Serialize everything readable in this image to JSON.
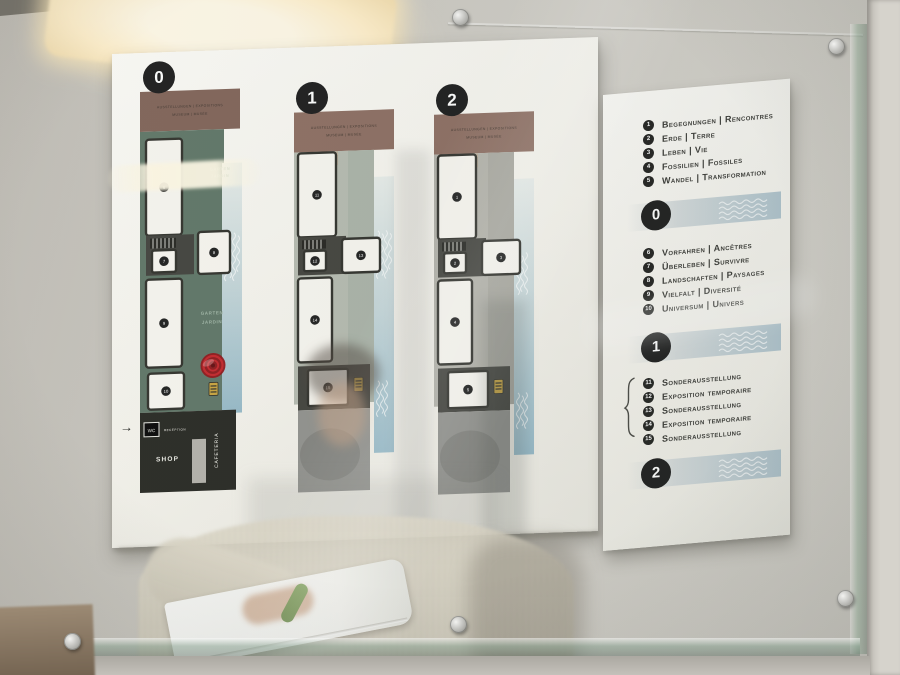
{
  "icons": {
    "entrance_arrow": "→",
    "brace": "{"
  },
  "colors": {
    "poster_white": "#f7f5f0",
    "band_brown": "#8a6a5e",
    "band_brown_floor0": "#7d5f54",
    "garden_green": "#5b7263",
    "floor1_bg": "#b4b9ae",
    "floor1_bg2": "#a8b1a6",
    "floor2_bg": "#b1b0a8",
    "floor2_bg2": "#a7a69e",
    "river_blue": "#94b8c7",
    "marker_red": "#a51016",
    "lift_yellow": "#c9a23a",
    "circle_black": "#161616"
  },
  "plans": {
    "floors": [
      {
        "badge": "0",
        "header_line1": "AUSSTELLUNGEN | EXPOSITIONS",
        "header_line2": "MUSEUM | MUSÉE",
        "bg": "#5b7263",
        "rooms": {
          "a": "6",
          "core": "7",
          "b": "8",
          "c": "9",
          "d": "10"
        },
        "garden": {
          "line1": "GARTEN",
          "line2": "JARDIN"
        },
        "amenities": {
          "wc": "WC",
          "reception": "RECEPTION",
          "shop": "SHOP",
          "cafeteria": "CAFETERIA"
        }
      },
      {
        "badge": "1",
        "header_line1": "AUSSTELLUNGEN | EXPOSITIONS",
        "header_line2": "MUSEUM | MUSÉE",
        "bg": "#b4b9ae",
        "bg2": "#a8b1a6",
        "rooms": {
          "a": "11",
          "core": "12",
          "b": "13",
          "c": "14",
          "d": "15"
        }
      },
      {
        "badge": "2",
        "header_line1": "AUSSTELLUNGEN | EXPOSITIONS",
        "header_line2": "MUSEUM | MUSÉE",
        "bg": "#b1b0a8",
        "bg2": "#a7a69e",
        "rooms": {
          "a": "1",
          "core": "2",
          "b": "3",
          "c": "4",
          "d": "5"
        }
      }
    ]
  },
  "legend": {
    "top_items": [
      {
        "num": "1",
        "label": "Begegnungen | Rencontres"
      },
      {
        "num": "2",
        "label": "Erde | Terre"
      },
      {
        "num": "3",
        "label": "Leben | Vie"
      },
      {
        "num": "4",
        "label": "Fossilien | Fossiles"
      },
      {
        "num": "5",
        "label": "Wandel | Transformation"
      }
    ],
    "floor0": {
      "badge": "0",
      "items": [
        {
          "num": "6",
          "label": "Vorfahren | Ancêtres"
        },
        {
          "num": "7",
          "label": "Überleben | Survivre"
        },
        {
          "num": "8",
          "label": "Landschaften | Paysages"
        },
        {
          "num": "9",
          "label": "Vielfalt | Diversité"
        },
        {
          "num": "10",
          "label": "Universum | Univers"
        }
      ]
    },
    "floor1": {
      "badge": "1",
      "items": [
        {
          "num": "11",
          "label": "Sonderausstellung"
        },
        {
          "num": "12",
          "label": "Exposition temporaire"
        },
        {
          "num": "13",
          "label": "Sonderausstellung"
        },
        {
          "num": "14",
          "label": "Exposition temporaire"
        },
        {
          "num": "15",
          "label": "Sonderausstellung"
        }
      ]
    },
    "floor2": {
      "badge": "2"
    }
  }
}
